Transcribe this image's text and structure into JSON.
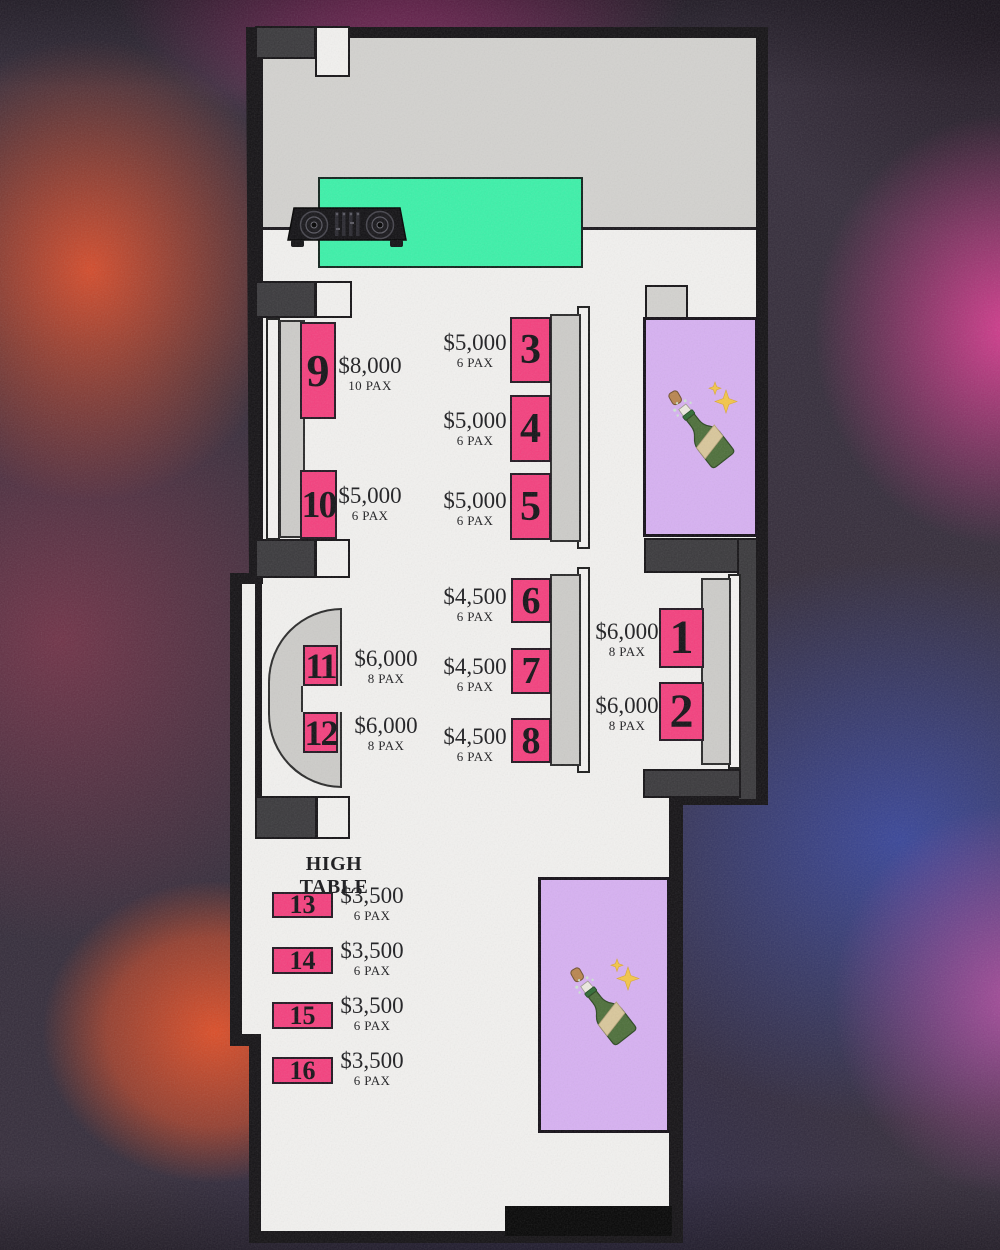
{
  "plan": {
    "high_table_heading": "HIGH TABLE",
    "tables": {
      "t1": {
        "number": "1",
        "price": "$6,000",
        "pax": "8 PAX"
      },
      "t2": {
        "number": "2",
        "price": "$6,000",
        "pax": "8 PAX"
      },
      "t3": {
        "number": "3",
        "price": "$5,000",
        "pax": "6 PAX"
      },
      "t4": {
        "number": "4",
        "price": "$5,000",
        "pax": "6 PAX"
      },
      "t5": {
        "number": "5",
        "price": "$5,000",
        "pax": "6 PAX"
      },
      "t6": {
        "number": "6",
        "price": "$4,500",
        "pax": "6 PAX"
      },
      "t7": {
        "number": "7",
        "price": "$4,500",
        "pax": "6 PAX"
      },
      "t8": {
        "number": "8",
        "price": "$4,500",
        "pax": "6 PAX"
      },
      "t9": {
        "number": "9",
        "price": "$8,000",
        "pax": "10 PAX"
      },
      "t10": {
        "number": "10",
        "price": "$5,000",
        "pax": "6 PAX"
      },
      "t11": {
        "number": "11",
        "price": "$6,000",
        "pax": "8 PAX"
      },
      "t12": {
        "number": "12",
        "price": "$6,000",
        "pax": "8 PAX"
      },
      "t13": {
        "number": "13",
        "price": "$3,500",
        "pax": "6 PAX"
      },
      "t14": {
        "number": "14",
        "price": "$3,500",
        "pax": "6 PAX"
      },
      "t15": {
        "number": "15",
        "price": "$3,500",
        "pax": "6 PAX"
      },
      "t16": {
        "number": "16",
        "price": "$3,500",
        "pax": "6 PAX"
      }
    },
    "icons": {
      "stage": "dj-controller-icon",
      "vip_top": "champagne-bottle-icon",
      "vip_bottom": "champagne-bottle-icon"
    },
    "colors": {
      "table_pink": "#f4407e",
      "stage_green": "#3cf1a9",
      "vip_purple": "#d7b1f2",
      "floor_white": "#f2f1ef",
      "stage_gray": "#d3d2cf",
      "bench_gray": "#cdccc9",
      "block_charcoal": "#3a393c",
      "wall_black": "#141215"
    }
  }
}
